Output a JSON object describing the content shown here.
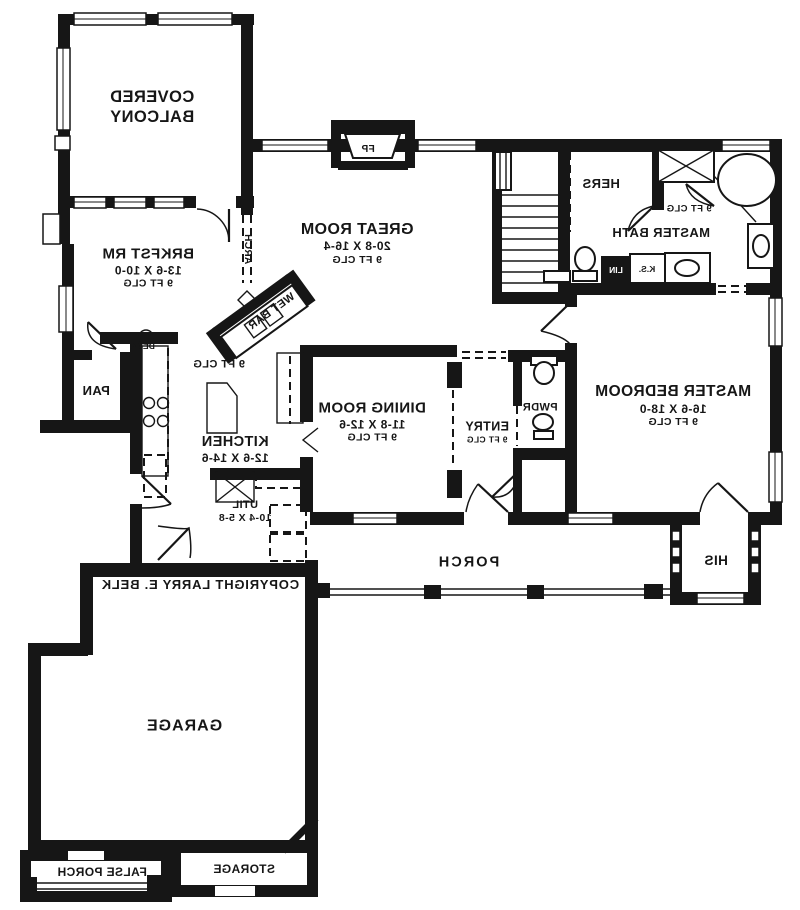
{
  "document": {
    "copyright": "COPYRIGHT LARRY E. BELK"
  },
  "colors": {
    "ink": "#161616",
    "paper": "#ffffff"
  },
  "rooms": {
    "covered_balcony": {
      "name": "COVERED BALCONY"
    },
    "great_room": {
      "name": "GREAT ROOM",
      "dims": "20-8 X 16-4",
      "clg": "9 FT CLG"
    },
    "brkfst": {
      "name": "BRKFST RM",
      "dims": "13-6 X 10-0",
      "clg": "9 FT CLG"
    },
    "kitchen": {
      "name": "KITCHEN",
      "dims": "12-6 X 14-6",
      "clg": "9 FT CLG"
    },
    "dining": {
      "name": "DINING ROOM",
      "dims": "11-8 X 12-6",
      "clg": "9 FT CLG"
    },
    "entry": {
      "name": "ENTRY",
      "clg": "9 FT CLG"
    },
    "powder": {
      "name": "PWDR"
    },
    "master_bedroom": {
      "name": "MASTER BEDROOM",
      "dims": "16-6 X 18-0",
      "clg": "9 FT CLG"
    },
    "master_bath": {
      "name": "MASTER BATH",
      "clg": "9 FT CLG"
    },
    "hers_closet": {
      "name": "HERS"
    },
    "his_closet": {
      "name": "HIS"
    },
    "pantry": {
      "name": "PAN"
    },
    "utility": {
      "name": "UTIL",
      "dims": "10-4 X 5-8"
    },
    "porch": {
      "name": "PORCH"
    },
    "garage": {
      "name": "GARAGE"
    },
    "storage": {
      "name": "STORAGE"
    },
    "false_porch": {
      "name": "FALSE PORCH"
    }
  },
  "features": {
    "fireplace": "FP",
    "wet_bar": "WET BAR",
    "arch": "ARCH",
    "desk": "DESK",
    "knee_space": "K.S.",
    "linen": "LIN"
  }
}
